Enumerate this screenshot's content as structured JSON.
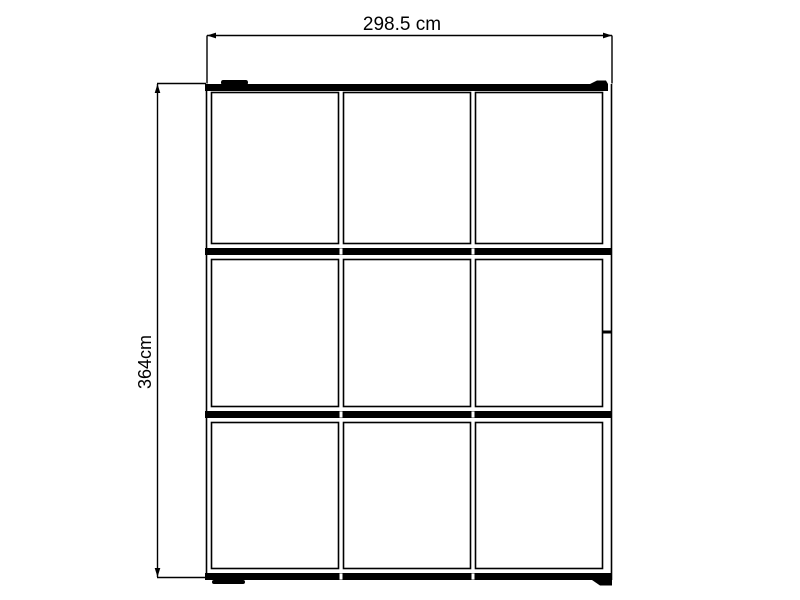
{
  "page": {
    "background": "#ffffff",
    "line_color": "#000000",
    "type": "technical-dimension-drawing"
  },
  "diagram": {
    "subject": "front elevation of a 3x3 glazed panel frame with top and bottom rails",
    "grid": {
      "rows": 3,
      "columns": 3
    },
    "features": [
      "top-rail",
      "bottom-rail",
      "two-row-divider-rails",
      "top-roller",
      "rail-end-cap",
      "left-foot",
      "right-foot",
      "right-frame-joint"
    ]
  },
  "dimensions": {
    "width": {
      "label": "298.5 cm",
      "value": 298.5,
      "unit": "cm"
    },
    "height": {
      "label": "364cm",
      "value": 364,
      "unit": "cm"
    }
  }
}
